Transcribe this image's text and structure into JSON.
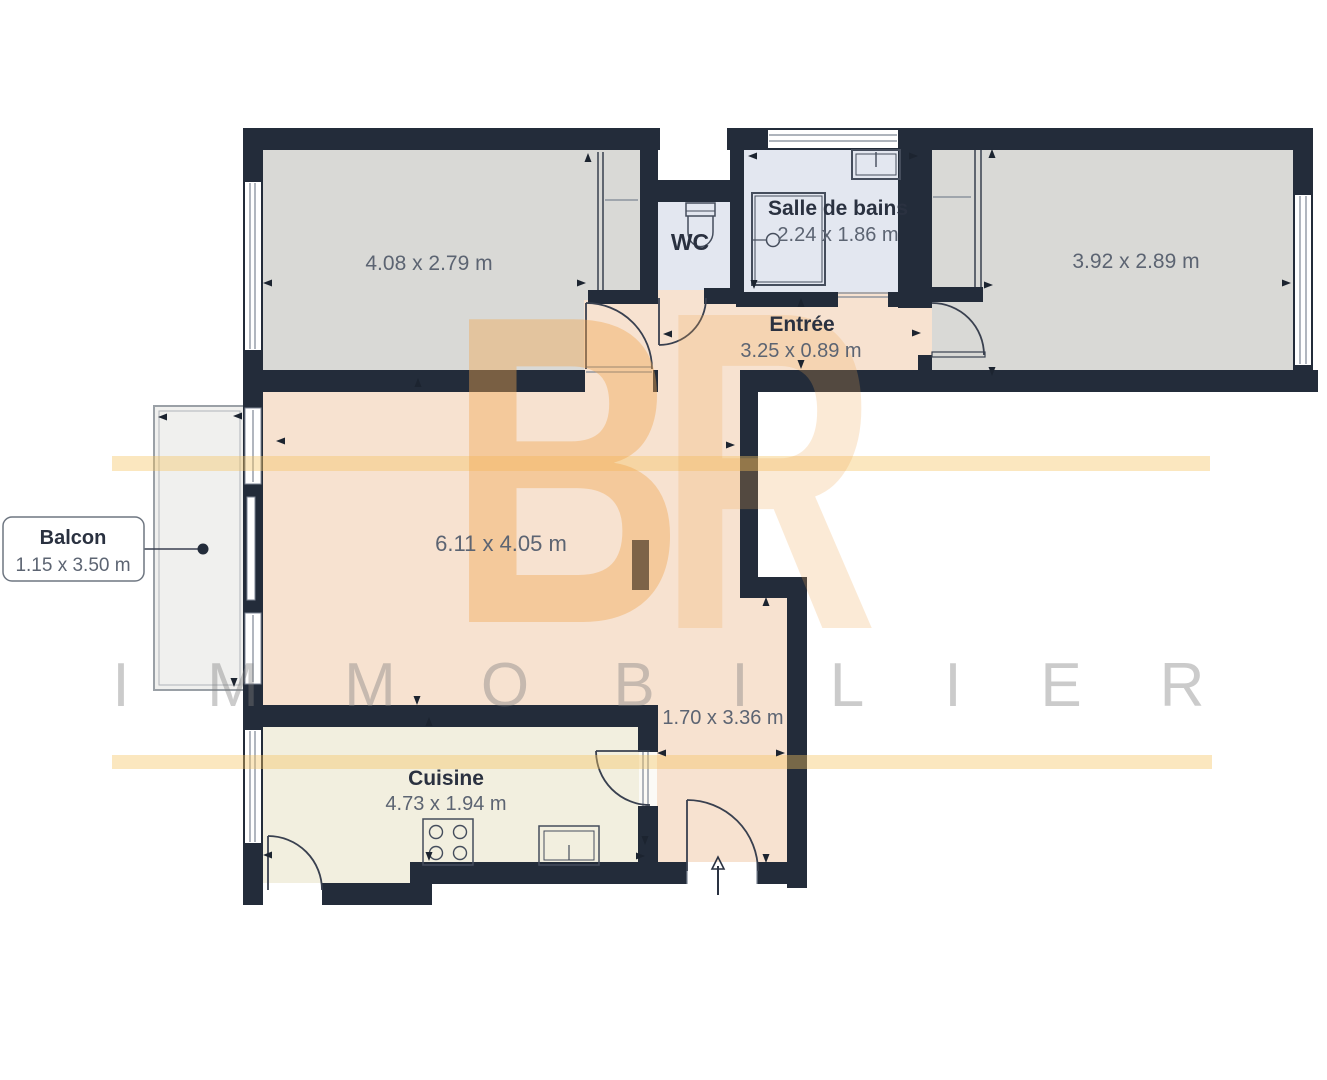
{
  "plan": {
    "type": "apartment-floor-plan",
    "language": "fr"
  },
  "rooms": {
    "bedroom_left": {
      "dims": "4.08 x 2.79 m"
    },
    "wc": {
      "name": "WC"
    },
    "bathroom": {
      "name": "Salle de bains",
      "dims": "2.24 x 1.86 m"
    },
    "bedroom_right": {
      "dims": "3.92 x 2.89 m"
    },
    "entry": {
      "name": "Entrée",
      "dims": "3.25 x 0.89 m"
    },
    "living": {
      "dims": "6.11 x 4.05 m"
    },
    "hall": {
      "dims": "1.70 x 3.36 m"
    },
    "kitchen": {
      "name": "Cuisine",
      "dims": "4.73 x 1.94 m"
    },
    "balcony": {
      "name": "Balcon",
      "dims": "1.15 x 3.50 m"
    }
  },
  "watermark": {
    "brand_letter_b": "B",
    "brand_letter_r": "R",
    "brand_text": "IMMOBILIER",
    "letters": [
      "I",
      "M",
      "M",
      "O",
      "B",
      "I",
      "L",
      "I",
      "E",
      "R"
    ]
  },
  "colors": {
    "wall": "#232c3a",
    "room_gray": "#d9d9d6",
    "room_peach": "#f7e2d0",
    "room_blue": "#e3e7f0",
    "room_cream": "#f2efdf",
    "balcony_fill": "#f0f0ee",
    "watermark_orange": "#f0a852",
    "watermark_gray": "#c9c9c9",
    "label_dark": "#2a3140",
    "label_dim": "#5c6472"
  }
}
